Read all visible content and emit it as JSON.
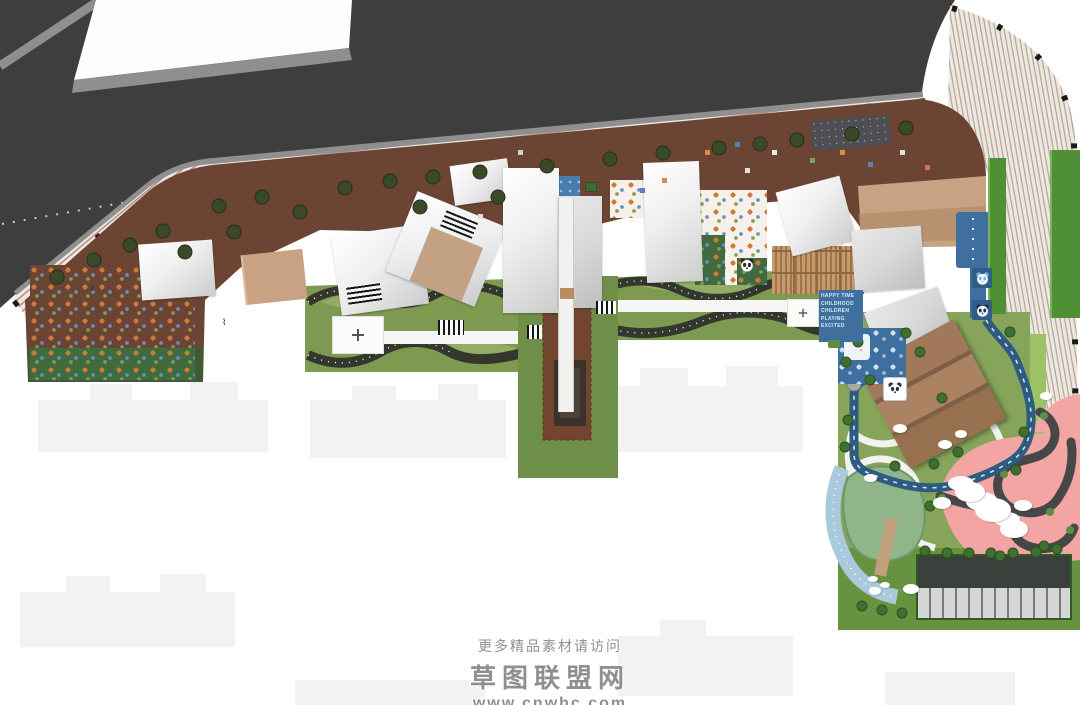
{
  "watermark": {
    "line1": "更多精品素材请访问",
    "line2": "草图联盟网",
    "line3": "www.cnwhc.com"
  },
  "playground_sign": {
    "lines": [
      "HAPPY TIME",
      "CHILDHOOD",
      "CHILDREN",
      "PLAYING",
      "EXCITED"
    ]
  },
  "palette": {
    "road": "#3e3e3e",
    "curb": "#8f8f8f",
    "sidewalk": "#efe9e1",
    "sidewalk_stripe": "#b5928a",
    "deck": "#6b4434",
    "plaza_tan": "#c7a383",
    "lawn": "#7d9a50",
    "lawn_light": "#93ad62",
    "lawn_dark_band": "#34372e",
    "axis_green": "#6e8f48",
    "axis_brown": "#73452f",
    "hedge": "#4f8f35",
    "water_blue": "#4a7dab",
    "kids_track_blue": "#2d5c80",
    "kids_panel_blue": "#3f6f9e",
    "pink": "#f2a5a2",
    "pink_track": "#474747",
    "pond": "#8fb588",
    "beach": "#a9c9dc",
    "parking_aisle": "#3c403d",
    "parking_stall": "#d6d6d6",
    "ghost": "#f2f2f2",
    "roof_brown": "#a3795c"
  },
  "icons": {
    "panda_icon": "panda-face",
    "compass_icon": "compass-rose",
    "tree_icon": "tree-canopy",
    "rock_icon": "white-boulder",
    "streetlight_icon": "street-light-square"
  }
}
